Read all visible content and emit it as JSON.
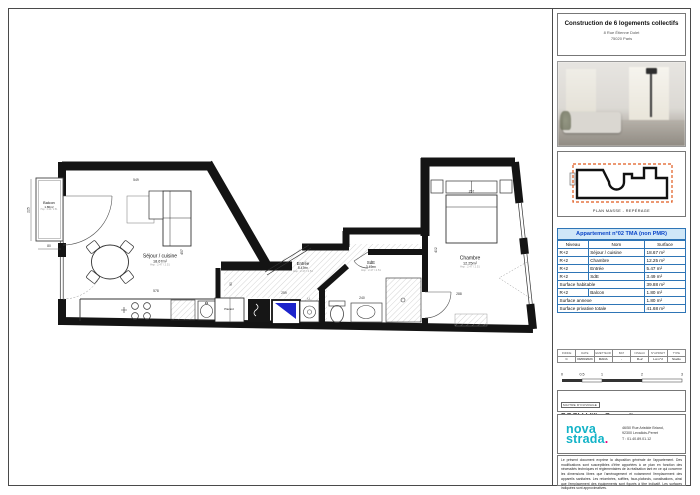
{
  "title_block": {
    "title": "Construction de 6 logements collectifs",
    "address1": "8 Rue Étienne Dolet",
    "address2": "75020 Paris"
  },
  "plan_masse": {
    "caption": "PLAN MASSE - REPÉRAGE"
  },
  "apartment_table": {
    "title": "Appartement n°02 TMA (non PMR)",
    "col_niveau": "Niveau",
    "col_nom": "Nom",
    "col_surface": "Surface",
    "rows": [
      {
        "niveau": "R+2",
        "nom": "Séjour / cuisine",
        "surface": "18.67 m²"
      },
      {
        "niveau": "R+2",
        "nom": "Chambre",
        "surface": "12.25 m²"
      },
      {
        "niveau": "R+2",
        "nom": "Entrée",
        "surface": "5.47 m²"
      },
      {
        "niveau": "R+2",
        "nom": "SdE",
        "surface": "3.49 m²"
      }
    ],
    "habitable_label": "Surface habitable",
    "habitable_value": "39.88 m²",
    "balcon_row": {
      "niveau": "R+2",
      "nom": "Balcon",
      "surface": "1.80 m²"
    },
    "annexe_label": "Surface annexe",
    "annexe_value": "1.80 m²",
    "privative_label": "Surface privative totale",
    "privative_value": "41.68 m²"
  },
  "revision_table": {
    "headers": [
      "INDICE",
      "DATE",
      "EMETTEUR",
      "BAT",
      "NIVEAU",
      "N°APPART",
      "TYPE"
    ],
    "values": [
      "C",
      "09/06/2023",
      "MADA",
      "-",
      "R+2",
      "Lot n°2",
      "Studio"
    ]
  },
  "scale_bar": {
    "t0": "0",
    "t05": "0.5",
    "t1": "1",
    "t2": "2",
    "t3": "3"
  },
  "owner": {
    "label": "MAITRE D'OUVRAGE",
    "name": "SCCV Villa Comedia"
  },
  "logo": {
    "word1": "nova",
    "word2": "strada",
    "dot": ".",
    "addr1": "46/50 Rue Aristide Briand,",
    "addr2": "92300 Levallois-Perret",
    "addr3": "T : 01.40.89.01.12"
  },
  "disclaimer": "Le présent document exprime la disposition générale de l'appartement. Des modifications sont susceptibles d'être apportées à ce plan en fonction des nécessités techniques et réglementaires de la réalisation tant en ce qui concerne les dimensions libres que l'aménagement et notamment l'emplacement des appareils sanitaires. Les retombées, soffites, faux-plafonds, canalisations, ainsi que l'emplacement des équipements sont figurés à titre indicatif. Les surfaces indiquées sont approximatives.",
  "plan": {
    "rooms": {
      "balcon": {
        "name": "Balcon",
        "area": "1.80m²",
        "hsp": "Hsp : 2.44 / 2.51"
      },
      "sejour": {
        "name": "Séjour / cuisine",
        "area": "18.67m²",
        "hsp": "Hsp : 2.47 / 2.51"
      },
      "entree": {
        "name": "Entrée",
        "area": "5.47m²",
        "hsp": "Hsp : 2.47 / 2.51"
      },
      "sde": {
        "name": "SdE",
        "area": "3.49m²",
        "hsp": "Hsp : 2.47 / 2.51"
      },
      "chambre": {
        "name": "Chambre",
        "area": "12.25m²",
        "hsp": "Hsp : 2.47 / 2.51"
      }
    },
    "labels": {
      "placard": "Placard",
      "ll": "LL"
    },
    "dims": {
      "sejour_w": "549",
      "sejour_h": "457",
      "kitchen_w": "578",
      "balcon_w": "80",
      "balcon_h": "225",
      "entree_w": "259",
      "entree_h": "90",
      "sde_w": "240",
      "chambre_w": "288",
      "bed_w": "257",
      "chambre_h": "402"
    }
  },
  "colors": {
    "wall": "#141414",
    "accent_blue": "#2e75b6",
    "table_header_bg": "#cfe7f8",
    "table_header_text": "#0b46c8",
    "door_blue": "#1c24cc",
    "masse_dash_orange": "#e05a1e",
    "logo_teal": "#12b3c7",
    "logo_dot_pink": "#e6007e"
  }
}
